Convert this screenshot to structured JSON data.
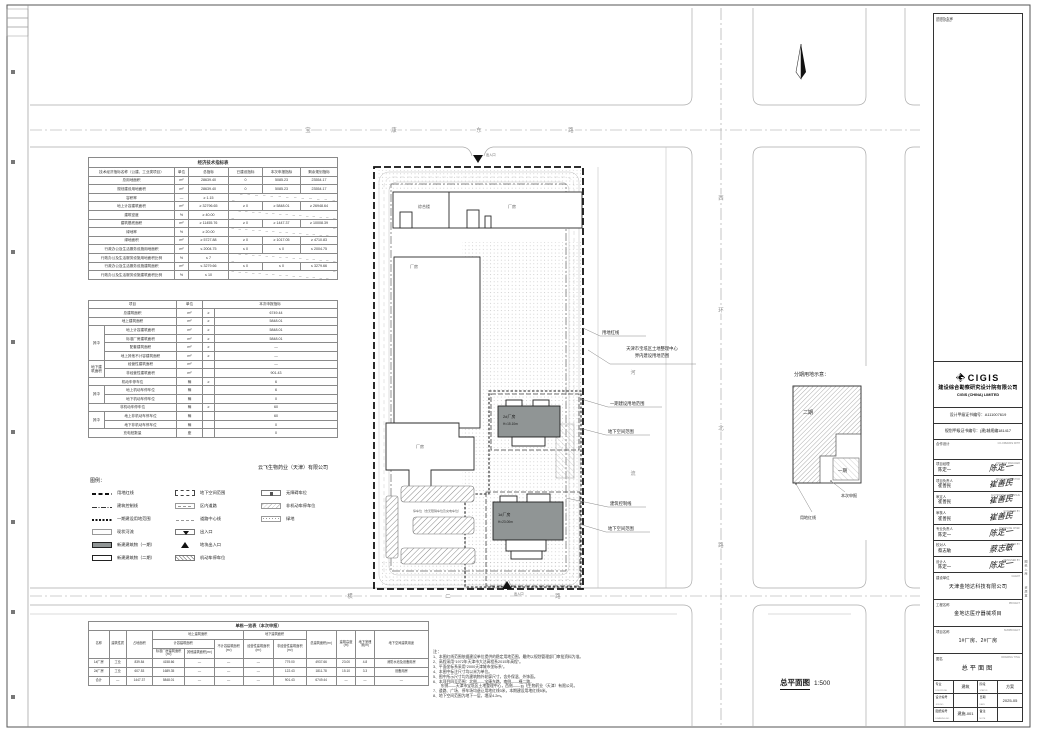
{
  "drawing": {
    "company_owner": "云飞生物药业（天津）有限公司",
    "scale_title": "总平面图",
    "scale_value": "1:500",
    "roads": {
      "top": [
        "宝",
        "康",
        "东",
        "路"
      ],
      "bottom": [
        "横",
        "二",
        "路"
      ],
      "right": [
        "西",
        "环",
        "北",
        "路"
      ],
      "river": [
        "河",
        "流"
      ]
    },
    "entrances": {
      "top": "出入口",
      "bottom": "出入口"
    },
    "buildings": {
      "b1_name": "1#厂房",
      "b1_height": "H=23.00m",
      "b2_name": "2#厂房",
      "b2_height": "H=15.10m",
      "annex": "综合楼",
      "factory": "厂房",
      "parking_note": "停车位（含无障碍车位及充电车位）"
    },
    "annotations": {
      "redline": "用地红线",
      "neighbor1": "天津市宝坻区土地整理中心",
      "neighbor2": "界内建设用地范围",
      "phase1_range": "一期建设用地范围",
      "underground1": "地下空间范围",
      "ctrl_line": "建筑控制线",
      "underground2": "地下空间范围"
    }
  },
  "phase_diagram": {
    "title": "分期用地示意：",
    "phase2": "二期",
    "phase1": "一期",
    "label_apply": "本次申报",
    "label_redline": "用地红线"
  },
  "legend": {
    "title": "图例：",
    "col1": [
      {
        "label": "用地红线"
      },
      {
        "label": "建筑控制线"
      },
      {
        "label": "一期建设用地范围"
      },
      {
        "label": "现状河流"
      },
      {
        "label": "新建建筑物（一期）"
      },
      {
        "label": "新建建筑物（二期）"
      }
    ],
    "col2": [
      {
        "label": "地下空间范围"
      },
      {
        "label": "区内道路"
      },
      {
        "label": "道路中心线"
      },
      {
        "label": "出入口"
      },
      {
        "label": "地块出入口"
      },
      {
        "label": "机动车停车位"
      }
    ],
    "col3": [
      {
        "label": "无障碍车位"
      },
      {
        "label": "非机动车停车位"
      },
      {
        "label": "绿地"
      }
    ]
  },
  "tables": {
    "indicators1": {
      "widths": [
        86,
        14,
        40,
        34,
        38,
        37
      ],
      "rows": [
        [
          {
            "t": "经济技术指标表",
            "cs": 6,
            "cls": "hd"
          }
        ],
        [
          {
            "t": "技术经济指标名称（公建、工业类项目）"
          },
          {
            "t": "单位"
          },
          {
            "t": "总指标"
          },
          {
            "t": "已建设指标"
          },
          {
            "t": "本次申报指标"
          },
          {
            "t": "剩余规划指标"
          }
        ],
        [
          "总用地面积",
          "m²",
          "28639.40",
          "0",
          "5085.23",
          "23554.17"
        ],
        [
          "规划建设用地面积",
          "m²",
          "28639.40",
          "0",
          "5085.23",
          "23554.17"
        ],
        [
          "容积率",
          "—",
          "≥ 1.15",
          {
            "t": "",
            "cs": 3,
            "cls": "diag"
          }
        ],
        [
          "地上计容建筑面积",
          "m²",
          "≥ 32796.65",
          "≥ 0",
          "≥ 5848.01",
          "≥ 26948.64"
        ],
        [
          "建筑密度",
          "%",
          "≥ 40.00",
          {
            "t": "",
            "cs": 3,
            "cls": "diag"
          }
        ],
        [
          "建筑基底面积",
          "m²",
          "≥ 11455.76",
          "≥ 0",
          "≥ 1447.37",
          "≥ 10008.39"
        ],
        [
          "绿地率",
          "%",
          "≥ 20.00",
          {
            "t": "",
            "cs": 3,
            "cls": "diag"
          }
        ],
        [
          "绿地面积",
          "m²",
          "≥ 5727.88",
          "≥ 0",
          "≥ 1017.05",
          "≥ 4710.83"
        ],
        [
          "行政办公及生活服务设施用地面积",
          "m²",
          "≤ 2004.75",
          "≤ 0",
          "≤ 0",
          "≤ 2004.75"
        ],
        [
          "行政办公及生活服务设施用地面积比例",
          "%",
          "≤ 7",
          {
            "t": "",
            "cs": 3,
            "cls": "diag"
          }
        ],
        [
          "行政办公及生活服务设施建筑面积",
          "m²",
          "≤ 3279.66",
          "≤ 0",
          "≤ 0",
          "≤ 3279.66"
        ],
        [
          "行政办公及生活服务设施建筑面积比例",
          "%",
          "≤ 10",
          {
            "t": "",
            "cs": 3,
            "cls": "diag"
          }
        ]
      ]
    },
    "indicators2": {
      "widths": [
        16,
        72,
        26,
        12,
        123
      ],
      "rows": [
        [
          {
            "t": "项目",
            "cs": 2
          },
          {
            "t": "单位"
          },
          {
            "t": "本次申报指标",
            "cs": 2
          }
        ],
        [
          {
            "t": "总建筑面积",
            "cs": 2
          },
          "m²",
          "≥",
          "6749.44"
        ],
        [
          {
            "t": "地上建筑面积",
            "cs": 2
          },
          "m²",
          "≥",
          "5848.01"
        ],
        [
          {
            "t": "其中",
            "rs": 4
          },
          {
            "t": "地上计容建筑面积"
          },
          "m²",
          "≥",
          "5848.01"
        ],
        [
          {
            "t": "标准厂房建筑面积"
          },
          "m²",
          "≥",
          "5848.01"
        ],
        [
          {
            "t": "配套建筑面积"
          },
          "m²",
          "≥",
          "—"
        ],
        [
          {
            "t": "地上其他不计容建筑面积"
          },
          "m²",
          "≥",
          "—"
        ],
        [
          {
            "t": "地下建筑面积",
            "rs": 2
          },
          {
            "t": "经营性建筑面积"
          },
          "m²",
          "",
          "—"
        ],
        [
          {
            "t": "非经营性建筑面积"
          },
          "m²",
          "",
          "901.43"
        ],
        [
          {
            "t": "机动车停车位",
            "cs": 2
          },
          "辆",
          "≥",
          "6"
        ],
        [
          {
            "t": "其中",
            "rs": 2
          },
          {
            "t": "地上机动车停车位"
          },
          "辆",
          "",
          "6"
        ],
        [
          {
            "t": "地下机动车停车位"
          },
          "辆",
          "",
          "0"
        ],
        [
          {
            "t": "非机动车停车位",
            "cs": 2
          },
          "辆",
          "≥",
          "60"
        ],
        [
          {
            "t": "其中",
            "rs": 2
          },
          {
            "t": "地上非机动车停车位"
          },
          "辆",
          "",
          "60"
        ],
        [
          {
            "t": "地下非机动车停车位"
          },
          "辆",
          "",
          "0"
        ],
        [
          {
            "t": "充电桩数量",
            "cs": 2
          },
          "座",
          "",
          "0"
        ]
      ]
    },
    "buildings": {
      "widths": [
        19,
        16,
        24,
        30,
        27,
        27,
        28,
        30,
        28,
        18,
        17,
        50
      ],
      "rows": [
        [
          {
            "t": "单栋一览表（本次申报）",
            "cs": 12,
            "cls": "hd"
          }
        ],
        [
          {
            "t": "名称",
            "rs": 3
          },
          {
            "t": "建筑性质",
            "rs": 3
          },
          {
            "t": "占地面积",
            "rs": 3
          },
          {
            "t": "地上建筑面积",
            "cs": 3
          },
          {
            "t": "地下建筑面积",
            "cs": 2
          },
          {
            "t": "总建筑面积(m²)",
            "rs": 3
          },
          {
            "t": "建筑高度(m)",
            "rs": 3
          },
          {
            "t": "地下室埋深(m)",
            "rs": 3
          },
          {
            "t": "地下空间建筑用途",
            "rs": 3
          }
        ],
        [
          {
            "t": "计容建筑面积",
            "cs": 2
          },
          {
            "t": "不计容建筑面积(m²)",
            "rs": 2
          },
          {
            "t": "经营性建筑面积(m²)",
            "rs": 2
          },
          {
            "t": "非经营性建筑面积(m²)",
            "rs": 2
          }
        ],
        [
          {
            "t": "标准厂房建筑面积(m²)"
          },
          {
            "t": "其他建筑面积(m²)"
          }
        ],
        [
          "1#厂房",
          "工业",
          "839.84",
          "4158.66",
          "—",
          "—",
          "—",
          "779.00",
          "4937.66",
          "23.00",
          "4.8",
          "消防水池及设备用房"
        ],
        [
          "2#厂房",
          "工业",
          "607.53",
          "1689.35",
          "—",
          "—",
          "—",
          "122.43",
          "1811.78",
          "15.10",
          "3.3",
          "设备用房"
        ],
        [
          "合计",
          "—",
          "1447.37",
          "5848.01",
          "—",
          "—",
          "—",
          "901.43",
          "6749.44",
          "—",
          "—",
          "—"
        ]
      ]
    }
  },
  "notes": {
    "title": "注：",
    "lines": [
      "1、本图红线范围依据建设单位提供的稳定用地范围，最终以规划管理部门审批资料为准。",
      "2、高程采用“1972年天津市大沽高程系2015年高程”。",
      "3、平面坐标系采用“2000天津城市坐标系”。",
      "4、本图中标注尺寸均以米为单位。",
      "5、图中所示尺寸均为建筑物外轮廓尺寸，含外保温、外饰面。",
      "6、本项目四至范围：北侧——宝康东路，南侧——横二路，",
      "　　东侧——天津市宝坻区土地整理中心，西侧——云飞生物药业（天津）有限公司。",
      "7、道路、广场、停车场均退让用地红线3米，本期建设用地红线5米。",
      "8、地下空间范围为地下一层，埋深4.2m。"
    ]
  },
  "titleblock": {
    "note_seal": {
      "cn": "说明及会审",
      "en": "NOTE & SEAL"
    },
    "logo": {
      "word": "CIGIS",
      "company_cn": "建设综合勘察研究设计院有限公司",
      "company_en": "CIGIS (CHINA) LIMITED",
      "cert1": "设计甲级证书编号：A111007619",
      "cert2": "规划甲级证书编号：(建)城规编181417"
    },
    "coop": {
      "cn": "合作设计",
      "en": "CO-OPERATE WITH"
    },
    "signatures": [
      {
        "role_cn": "项目经理",
        "role_en": "PROJECT MANAGER",
        "name": "陈定一",
        "sig": "陈定一"
      },
      {
        "role_cn": "项目负责人",
        "role_en": "PROJECT DIRECTOR",
        "name": "崔善民",
        "sig": "崔善民"
      },
      {
        "role_cn": "审定人",
        "role_en": "AUTHORIZED FOR ISSUE",
        "name": "崔善民",
        "sig": "崔善民"
      },
      {
        "role_cn": "审核人",
        "role_en": "EXAMINED BY",
        "name": "崔善民",
        "sig": "崔善民"
      },
      {
        "role_cn": "专业负责人",
        "role_en": "DISCIPLINE CHIEF",
        "name": "陈定一",
        "sig": "陈定一"
      },
      {
        "role_cn": "校对人",
        "role_en": "CHECKED BY",
        "name": "蔡志敏",
        "sig": "蔡志敏"
      },
      {
        "role_cn": "设计人",
        "role_en": "DESIGNED BY",
        "name": "陈定一",
        "sig": "陈定一"
      }
    ],
    "fields": [
      {
        "label_cn": "建设单位",
        "label_en": "CLIENT",
        "value": "天津金地达科技有限公司"
      },
      {
        "label_cn": "工程名称",
        "label_en": "PROJECT",
        "value": "金地达医疗器械项目"
      },
      {
        "label_cn": "项目名称",
        "label_en": "SUBPROJECT",
        "value": "1#厂房、2#厂房"
      },
      {
        "label_cn": "图名",
        "label_en": "DRAWING TITLE",
        "value": "总平面图"
      }
    ],
    "grid": [
      {
        "l": "专业",
        "e": "DISCIPLINE",
        "v": "建筑"
      },
      {
        "l": "阶段",
        "e": "STATUS",
        "v": "方案"
      },
      {
        "l": "设计编号",
        "e": "JOB NO.",
        "v": ""
      },
      {
        "l": "日期",
        "e": "DATE",
        "v": "2025-05"
      },
      {
        "l": "图纸编号",
        "e": "DRAWING NO.",
        "v": "建施-001"
      },
      {
        "l": "备注",
        "e": "NOTE",
        "v": ""
      }
    ],
    "right_strip": [
      "图纸入库",
      "资质章"
    ]
  }
}
